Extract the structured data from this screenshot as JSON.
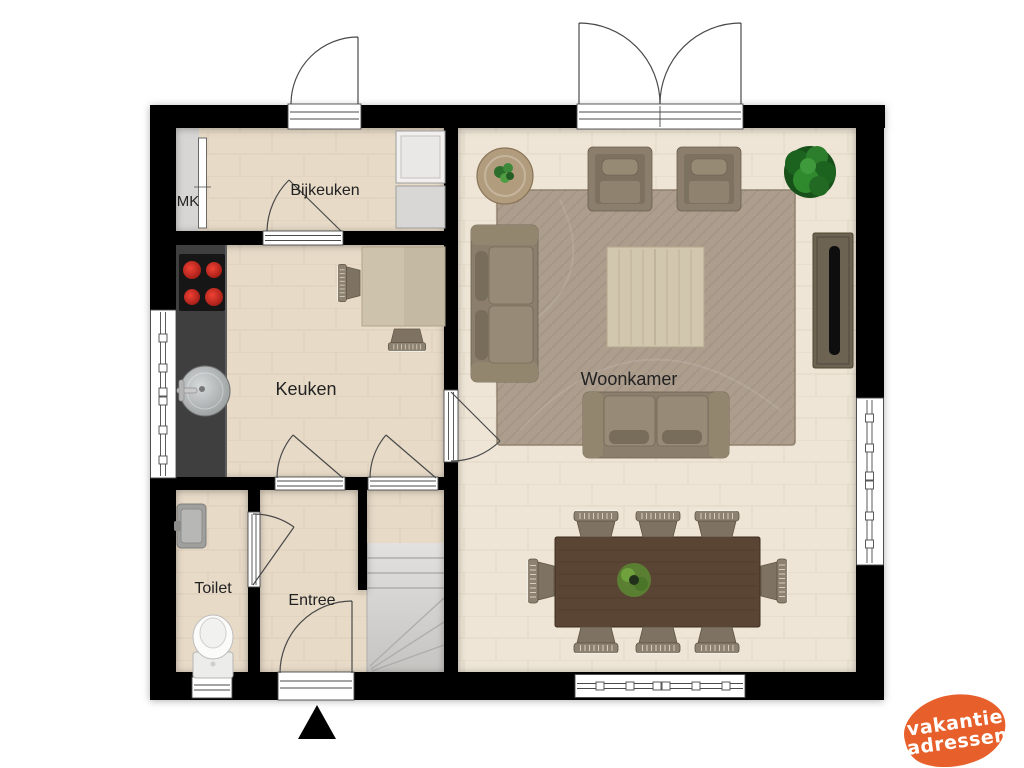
{
  "plan": {
    "title": "floor-plan",
    "rooms": {
      "mk": {
        "label": "MK"
      },
      "bijkeuken": {
        "label": "Bijkeuken"
      },
      "keuken": {
        "label": "Keuken"
      },
      "woonkamer": {
        "label": "Woonkamer"
      },
      "toilet": {
        "label": "Toilet"
      },
      "entree": {
        "label": "Entree"
      }
    },
    "compass": {
      "icon": "north-arrow"
    },
    "colors": {
      "wall": "#000000",
      "floor_main": "#e7dac7",
      "floor_living": "#eee5d6",
      "floor_mk": "#d7d6d4",
      "rug": "#ac9d8d",
      "counter": "#3f3f3f",
      "stairs": "#d9d7d4",
      "dining_table": "#5a4433",
      "sofa": "#8b7e6c",
      "plant": "#2a7d2b",
      "burner_red": "#cc2015"
    }
  },
  "logo": {
    "line1": "vakantie",
    "line2": "adressen",
    "bg_color": "#e7602b",
    "text_color": "#ffffff"
  }
}
